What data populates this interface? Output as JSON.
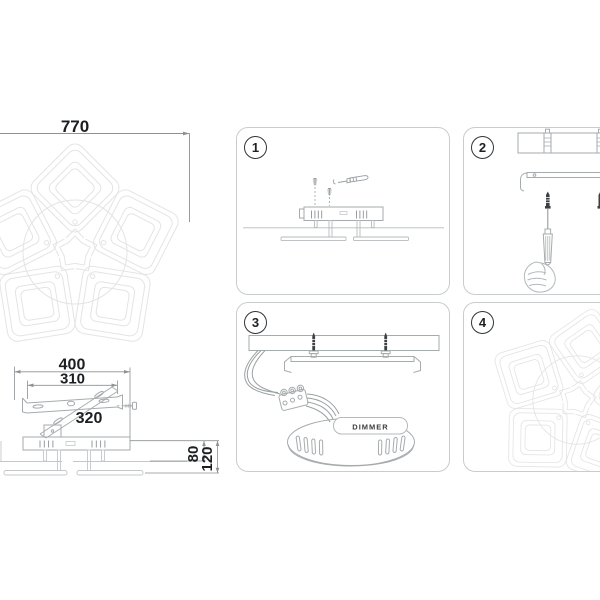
{
  "manual": {
    "dimensions": {
      "overall_width": "770",
      "mount_plate_width": "400",
      "bracket_length": "310",
      "cross_bracket_length": "320",
      "base_height": "80",
      "total_height": "120"
    },
    "steps": [
      {
        "number": "1",
        "illustration": "lamp-base-side-view-unscrew-screws"
      },
      {
        "number": "2",
        "illustration": "screw-bracket-to-ceiling-anchors-with-screwdriver"
      },
      {
        "number": "3",
        "illustration": "connect-wires-terminal-block-to-driver-canopy"
      },
      {
        "number": "4",
        "illustration": "finished-chandelier-flower-top-view"
      }
    ],
    "driver_label": "DIMMER",
    "colors": {
      "background": "#ffffff",
      "panel_border": "#c9cccd",
      "faint_line": "#e4e4e4",
      "medium_line": "#a6abad",
      "dim_line": "#8d9294",
      "text": "#1c1f21",
      "dark_fill": "#3c4042"
    }
  }
}
